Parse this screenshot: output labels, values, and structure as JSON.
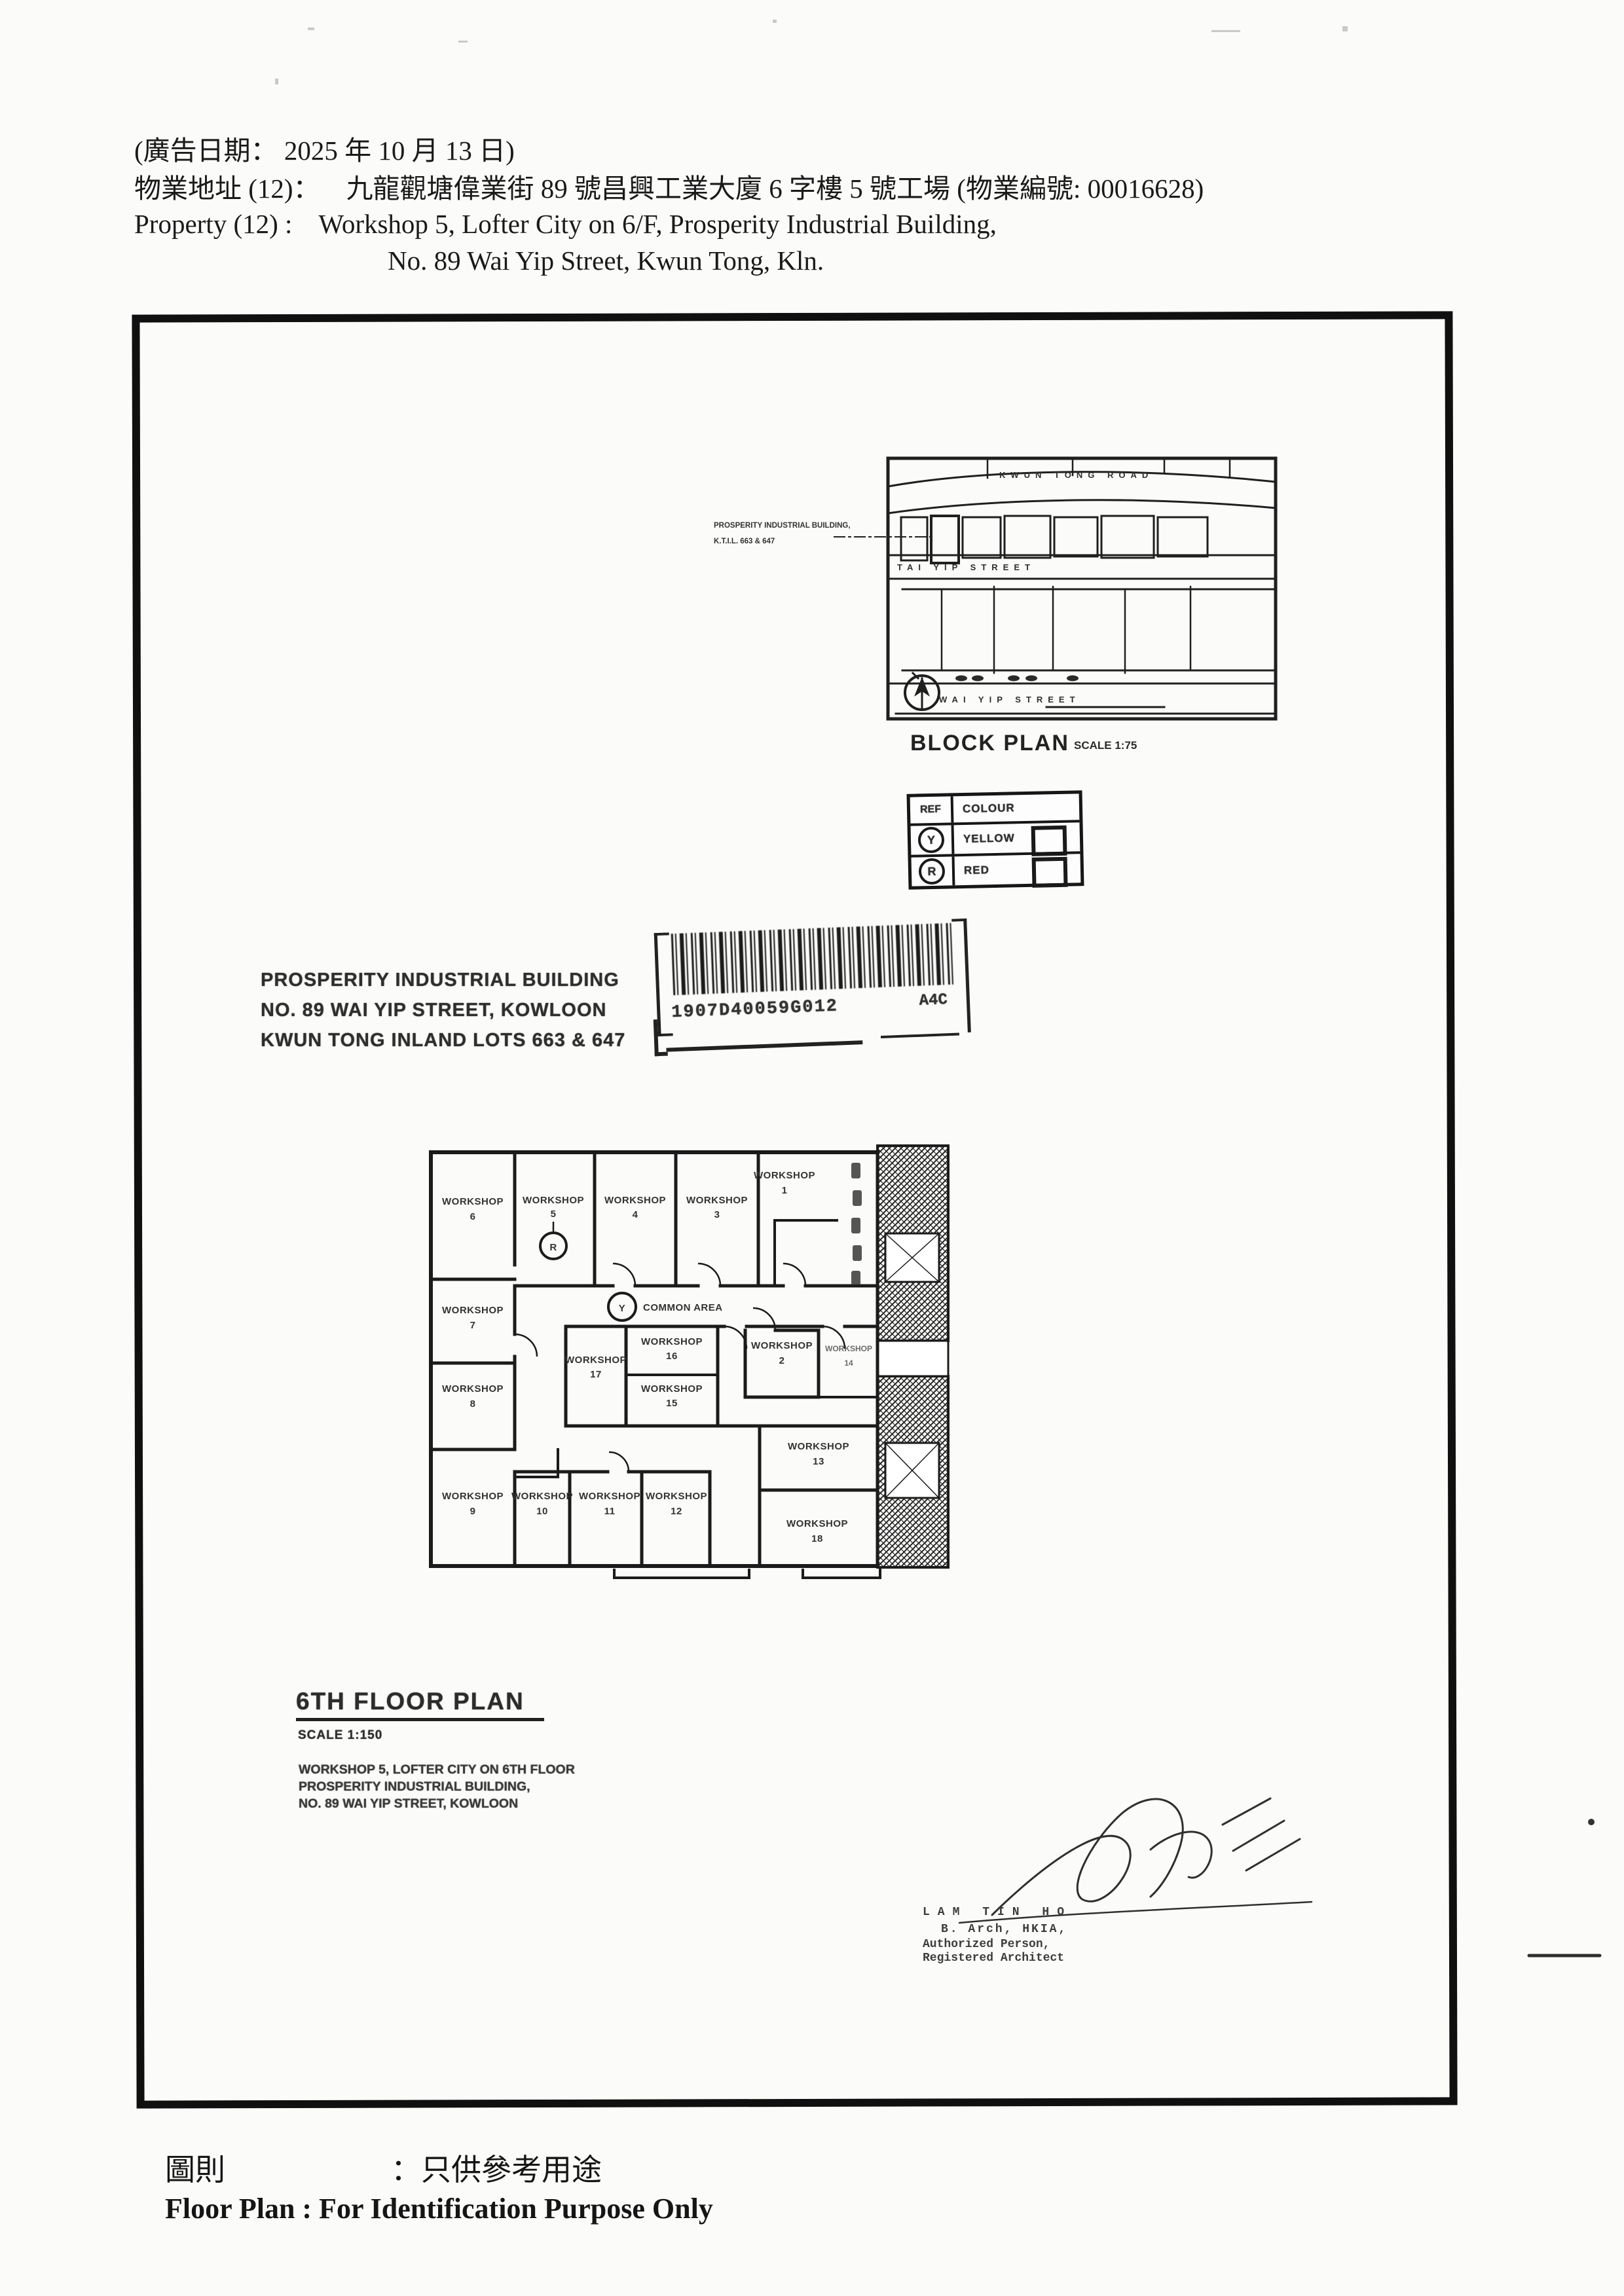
{
  "header": {
    "date_line": "(廣告日期：  2025 年 10 月 13 日)",
    "address_label": "物業地址  (12)：",
    "address_value": "九龍觀塘偉業街 89 號昌興工業大廈 6 字樓 5 號工場  (物業編號: 00016628)",
    "property_label": "Property    (12) :",
    "property_value": "Workshop 5, Lofter City on 6/F, Prosperity Industrial Building,",
    "property_value2": "No. 89 Wai Yip Street, Kwun Tong, Kln."
  },
  "block_plan": {
    "callout": [
      "PROSPERITY INDUSTRIAL BUILDING,",
      "K.T.I.L. 663 & 647"
    ],
    "streets": {
      "top": "KWUN TONG ROAD",
      "middle": "TAI YIP STREET",
      "bottom": "WAI YIP STREET"
    },
    "title": "BLOCK PLAN",
    "scale": "SCALE 1:75"
  },
  "legend": {
    "col_ref": "REF",
    "col_colour": "COLOUR",
    "rows": [
      {
        "ref": "Y",
        "colour": "YELLOW"
      },
      {
        "ref": "R",
        "colour": "RED"
      }
    ]
  },
  "barcode": {
    "number": "1907D40059G012",
    "suffix": "A4C"
  },
  "site_lines": [
    "PROSPERITY INDUSTRIAL BUILDING",
    "NO. 89 WAI YIP STREET, KOWLOON",
    "KWUN TONG INLAND LOTS 663 & 647"
  ],
  "floor_plan": {
    "title": "6TH FLOOR PLAN",
    "scale": "SCALE 1:150",
    "common_area": "COMMON AREA",
    "workshop_word": "WORKSHOP",
    "markers": {
      "yellow": "Y",
      "red": "R"
    },
    "rooms": {
      "r1": "1",
      "r2": "2",
      "r3": "3",
      "r4": "4",
      "r5": "5",
      "r6": "6",
      "r7": "7",
      "r8": "8",
      "r9": "9",
      "r10": "10",
      "r11": "11",
      "r12": "12",
      "r13": "13",
      "r14": "14",
      "r15": "15",
      "r16": "16",
      "r17": "17",
      "r18": "18"
    },
    "notes": [
      "WORKSHOP 5, LOFTER CITY ON 6TH FLOOR",
      "PROSPERITY INDUSTRIAL BUILDING,",
      "NO. 89 WAI YIP STREET, KOWLOON"
    ]
  },
  "signature": {
    "name": "LAM TIN HO",
    "line2": "B. Arch, HKIA,",
    "line3": "Authorized Person,",
    "line4": "Registered Architect"
  },
  "footer": {
    "cn_label": "圖則",
    "cn_colon": "：",
    "cn_value": "只供參考用途",
    "en": "Floor Plan : For Identification Purpose Only"
  }
}
